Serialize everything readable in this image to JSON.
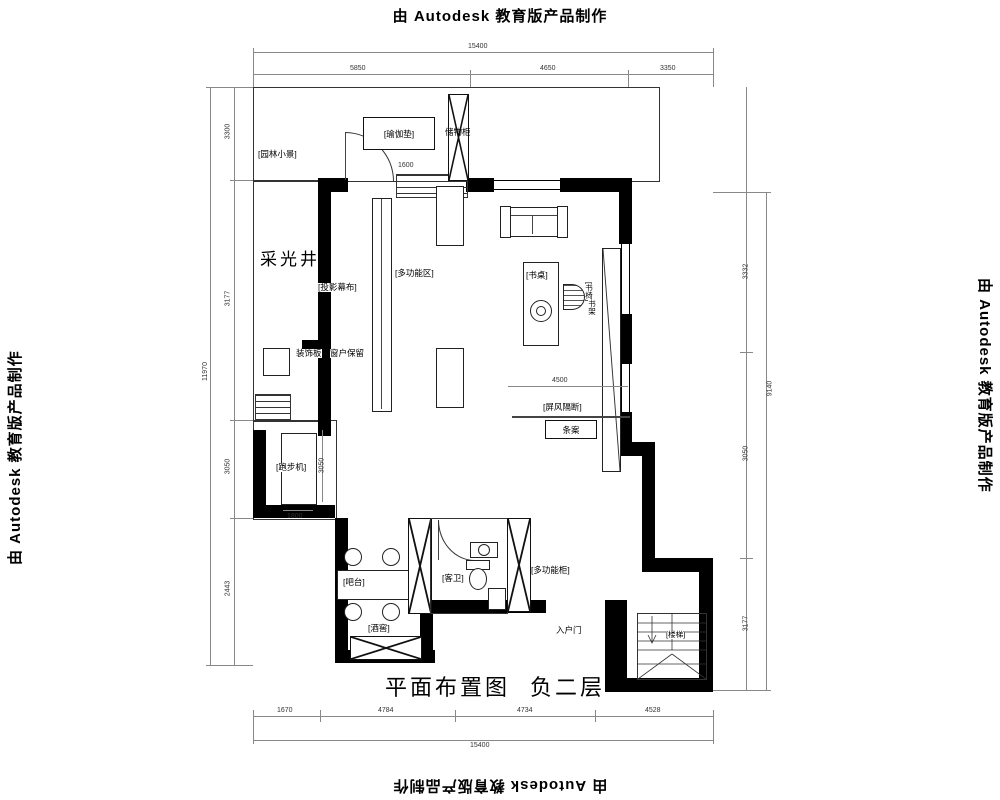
{
  "watermark": "由 Autodesk 教育版产品制作",
  "plan_title": {
    "name": "平面布置图",
    "floor": "负二层"
  },
  "labels": {
    "garden": "[园林小景]",
    "yoga_mat": "[瑜伽垫]",
    "storage_cabinet": "储物柜",
    "light_well": "采光井",
    "projector_screen": "[投影幕布]",
    "multi_area": "[多功能区]",
    "deco_board": "装饰板",
    "window_keep": "窗户保留",
    "desk": "[书桌]",
    "desk_chair": "[书椅]",
    "bookshelf": "书架",
    "screen_partition": "[屏风隔断]",
    "console_table": "条案",
    "treadmill": "[跑步机]",
    "bar": "[吧台]",
    "wine_cellar": "[酒窖]",
    "guest_bath": "[客卫]",
    "multi_cabinet": "[多功能柜]",
    "entry_door": "入户门",
    "stairs": "[楼梯]"
  },
  "dimensions": {
    "top_overall": "15400",
    "top_segments": [
      "5850",
      "4650",
      "3350"
    ],
    "bottom_segments": [
      "1670",
      "4784",
      "4734",
      "4528"
    ],
    "bottom_overall": "15400",
    "left_segments": [
      "3300",
      "3177",
      "3050",
      "2443"
    ],
    "left_overall": "11970",
    "right_segments": [
      "3332",
      "3050",
      "3177"
    ],
    "right_overall": "9140",
    "door_width": "1600",
    "study_width": "4500",
    "treadmill_width": "1800",
    "treadmill_depth": "3050"
  }
}
